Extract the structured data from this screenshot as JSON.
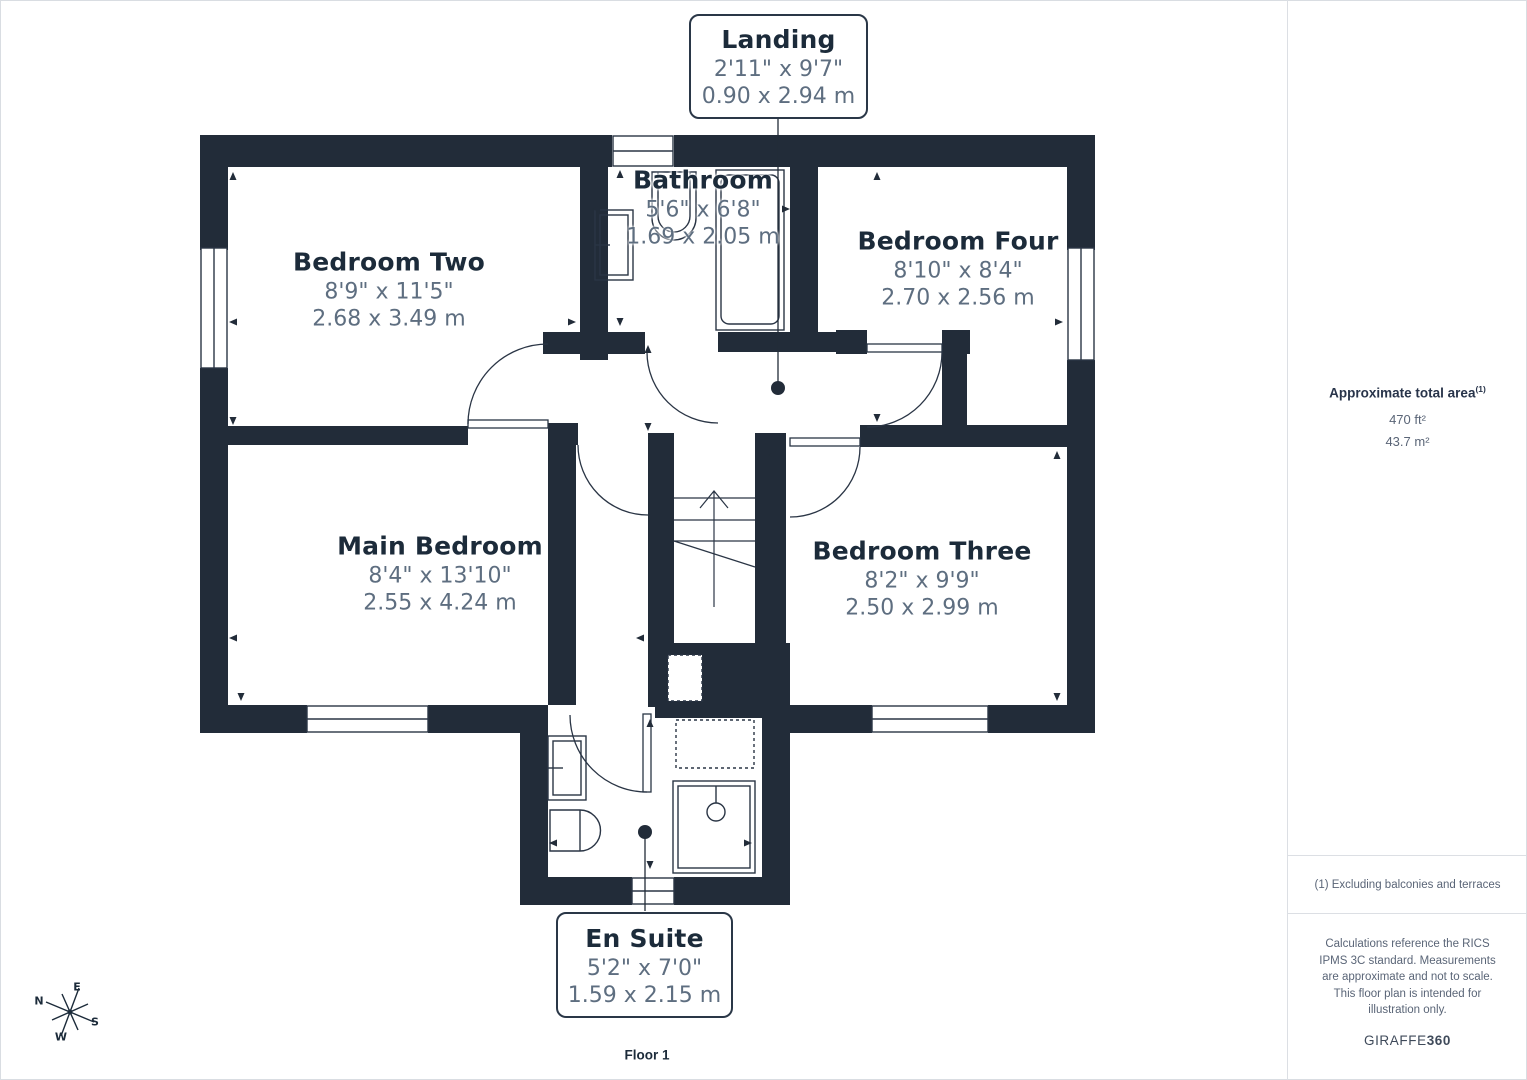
{
  "floor_label": "Floor 1",
  "rooms": [
    {
      "id": "landing",
      "name": "Landing",
      "imperial": "2'11\" x 9'7\"",
      "metric": "0.90 x 2.94 m"
    },
    {
      "id": "bathroom",
      "name": "Bathroom",
      "imperial": "5'6\" x 6'8\"",
      "metric": "1.69 x 2.05 m"
    },
    {
      "id": "bedroom-two",
      "name": "Bedroom Two",
      "imperial": "8'9\" x 11'5\"",
      "metric": "2.68 x 3.49 m"
    },
    {
      "id": "bedroom-four",
      "name": "Bedroom Four",
      "imperial": "8'10\" x 8'4\"",
      "metric": "2.70 x 2.56 m"
    },
    {
      "id": "main-bedroom",
      "name": "Main Bedroom",
      "imperial": "8'4\" x 13'10\"",
      "metric": "2.55 x 4.24 m"
    },
    {
      "id": "bedroom-three",
      "name": "Bedroom Three",
      "imperial": "8'2\" x 9'9\"",
      "metric": "2.50 x 2.99 m"
    },
    {
      "id": "en-suite",
      "name": "En Suite",
      "imperial": "5'2\" x 7'0\"",
      "metric": "1.59 x 2.15 m"
    }
  ],
  "sidebar": {
    "area_title": "Approximate total area",
    "area_superscript": "(1)",
    "area_ft": "470 ft²",
    "area_m": "43.7 m²",
    "footnote": "(1) Excluding balconies and terraces",
    "disclaimer": "Calculations reference the RICS IPMS 3C standard. Measurements are approximate and not to scale. This floor plan is intended for illustration only.",
    "brand_name": "GIRAFFE",
    "brand_suffix": "360"
  },
  "compass": {
    "n": "N",
    "e": "E",
    "s": "S",
    "w": "W"
  },
  "colors": {
    "wall": "#222c39",
    "title_text": "#1c2b3a",
    "dims_text": "#5e6e80"
  }
}
